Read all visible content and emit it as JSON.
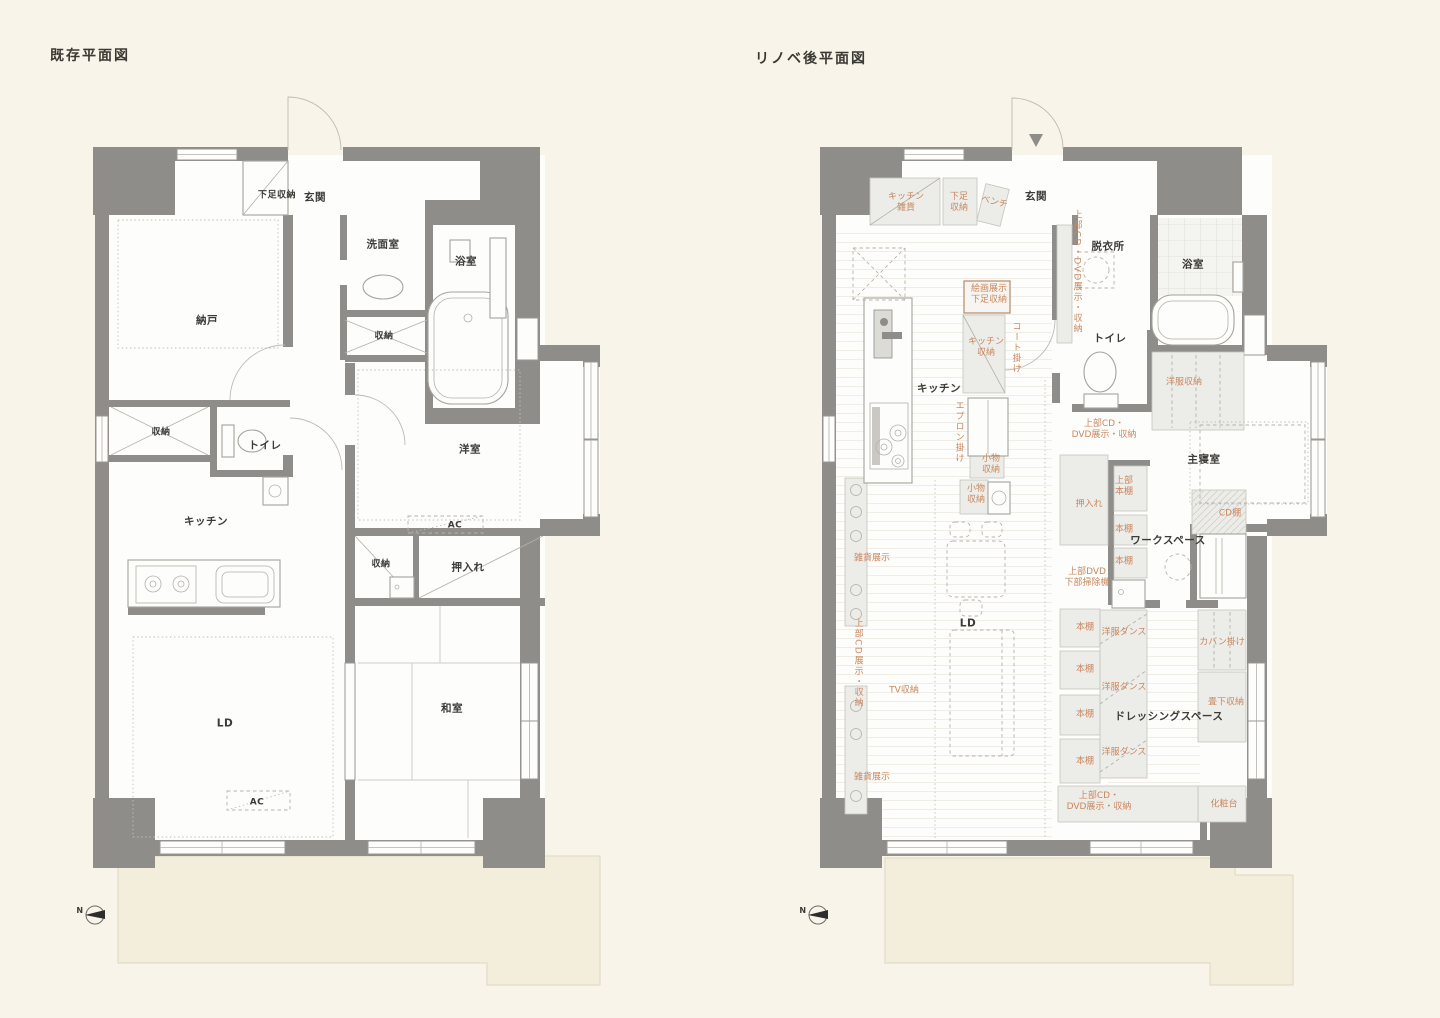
{
  "colors": {
    "background": "#f8f4e9",
    "wall": "#8e8d8a",
    "balcony": "#f3eddb",
    "room_text": "#3c3b37",
    "annotation_text": "#c9875f",
    "shelf_fill": "#ecece8"
  },
  "plans": {
    "existing": {
      "title": "既存平面図",
      "compass": "N",
      "labels": {
        "geta_shuno": "下足収納",
        "genkan": "玄関",
        "senmen": "洗面室",
        "yokushitsu": "浴室",
        "shuno_bath": "収納",
        "nando": "納戸",
        "shuno_hall": "収納",
        "toilet": "トイレ",
        "kitchen": "キッチン",
        "youshitsu": "洋室",
        "ac_youshitsu": "AC",
        "shuno_oshiire": "収納",
        "oshiire": "押入れ",
        "ld": "LD",
        "ac_ld": "AC",
        "washitsu": "和室"
      }
    },
    "renovated": {
      "title": "リノベ後平面図",
      "compass": "N",
      "labels": {
        "kitchen_zakka": "キッチン\n雑貨",
        "geta_shuno": "下足\n収納",
        "bench": "ベンチ",
        "genkan": "玄関",
        "datsuijo": "脱衣所",
        "yokushitsu": "浴室",
        "kaiga_tenji": "絵画展示\n下足収納",
        "cd_dvd_corridor": "上部CD・DVD展示・収納",
        "toilet": "トイレ",
        "yofuku_shuno": "洋服収納",
        "kitchen": "キッチン",
        "kitchen_shuno": "キッチン\n収納",
        "coat_kake": "コート掛け",
        "apron_kake": "エプロン掛け",
        "komono_1": "小物\n収納",
        "komono_2": "小物\n収納",
        "cd_dvd_upper": "上部CD・\nDVD展示・収納",
        "shushin": "主寝室",
        "oshiire": "押入れ",
        "joubu_hondana": "上部\n本棚",
        "hondana_1": "本棚",
        "hondana_2": "本棚",
        "dvd_souji": "上部DVD\n下部掃除機",
        "cd_dana": "CD棚",
        "workspace": "ワークスペース",
        "zakka_1": "雑貨展示",
        "cd_tenji": "上部CD展示・収納",
        "tv_shuno": "TV収納",
        "ld": "LD",
        "zakka_2": "雑貨展示",
        "hondana_3": "本棚",
        "hondana_4": "本棚",
        "hondana_5": "本棚",
        "hondana_6": "本棚",
        "tansu_1": "洋服ダンス",
        "tansu_2": "洋服ダンス",
        "tansu_3": "洋服ダンス",
        "kaban_kake": "カバン掛け",
        "tatami_shuno": "畳下収納",
        "dressing": "ドレッシングスペース",
        "cd_dvd_bottom": "上部CD・\nDVD展示・収納",
        "keshodai": "化粧台"
      }
    }
  }
}
